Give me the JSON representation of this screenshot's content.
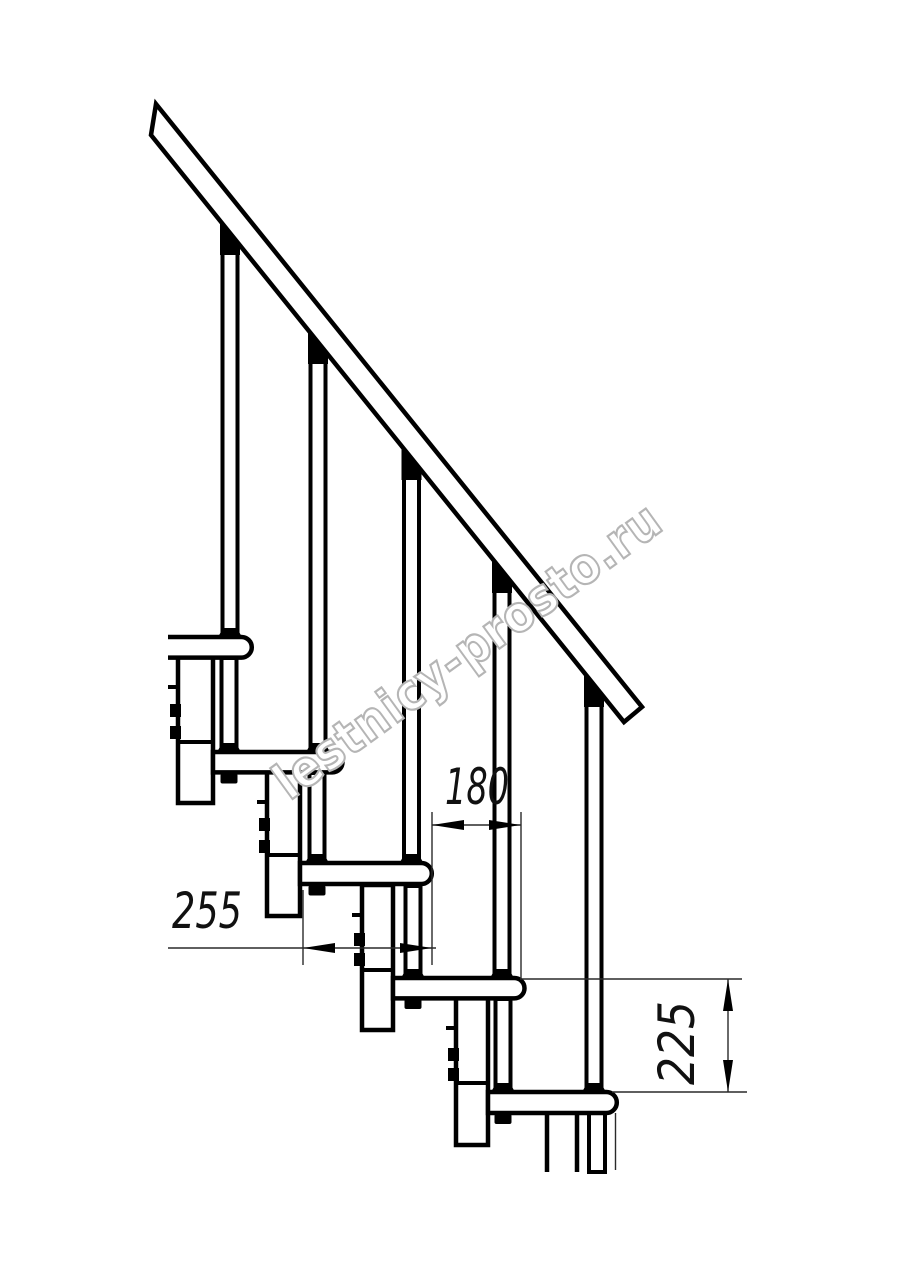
{
  "drawing": {
    "type": "modular-staircase-side-view",
    "background": "#ffffff",
    "line_color": "#000000",
    "dimensions": {
      "tread_depth": "255",
      "step_run": "180",
      "step_rise": "225"
    },
    "watermark": {
      "text": "lestnicy-prosto.ru",
      "color": "#b5b5b5",
      "fill": "#ffffff"
    }
  }
}
